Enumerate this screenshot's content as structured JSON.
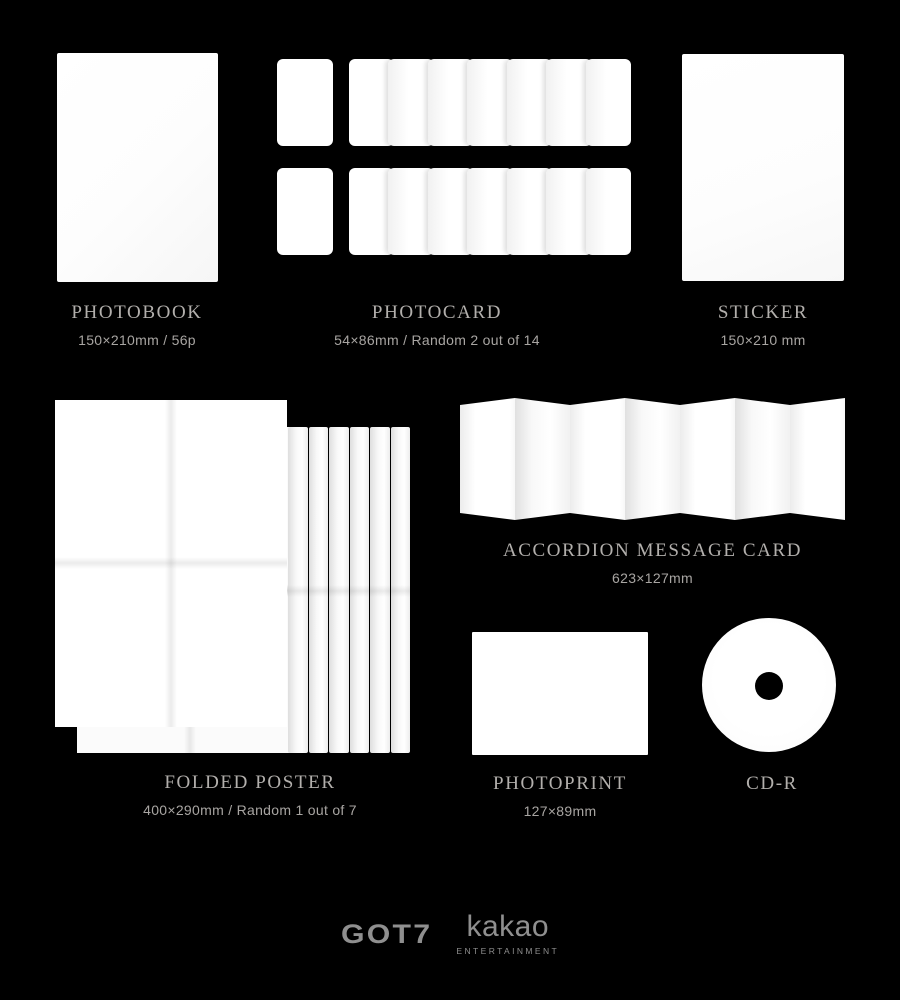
{
  "page": {
    "background": "#000000"
  },
  "items": {
    "photobook": {
      "name": "PHOTOBOOK",
      "spec": "150×210mm / 56p"
    },
    "photocard": {
      "name": "PHOTOCARD",
      "spec": "54×86mm / Random 2 out of 14"
    },
    "sticker": {
      "name": "STICKER",
      "spec": "150×210 mm"
    },
    "accordion_message_card": {
      "name": "ACCORDION MESSAGE CARD",
      "spec": "623×127mm"
    },
    "folded_poster": {
      "name": "FOLDED POSTER",
      "spec": "400×290mm / Random 1 out of 7"
    },
    "photoprint": {
      "name": "PHOTOPRINT",
      "spec": "127×89mm"
    },
    "cd_r": {
      "name": "CD-R"
    }
  },
  "footer": {
    "artist_logo": "GOT7",
    "publisher_logo": "kakao",
    "publisher_sub": "ENTERTAINMENT"
  },
  "colors": {
    "background": "#000000",
    "item_name": "#b2afac",
    "item_spec": "#a8a5a2",
    "logo": "#8f8f8f",
    "mockup_white": "#ffffff"
  }
}
